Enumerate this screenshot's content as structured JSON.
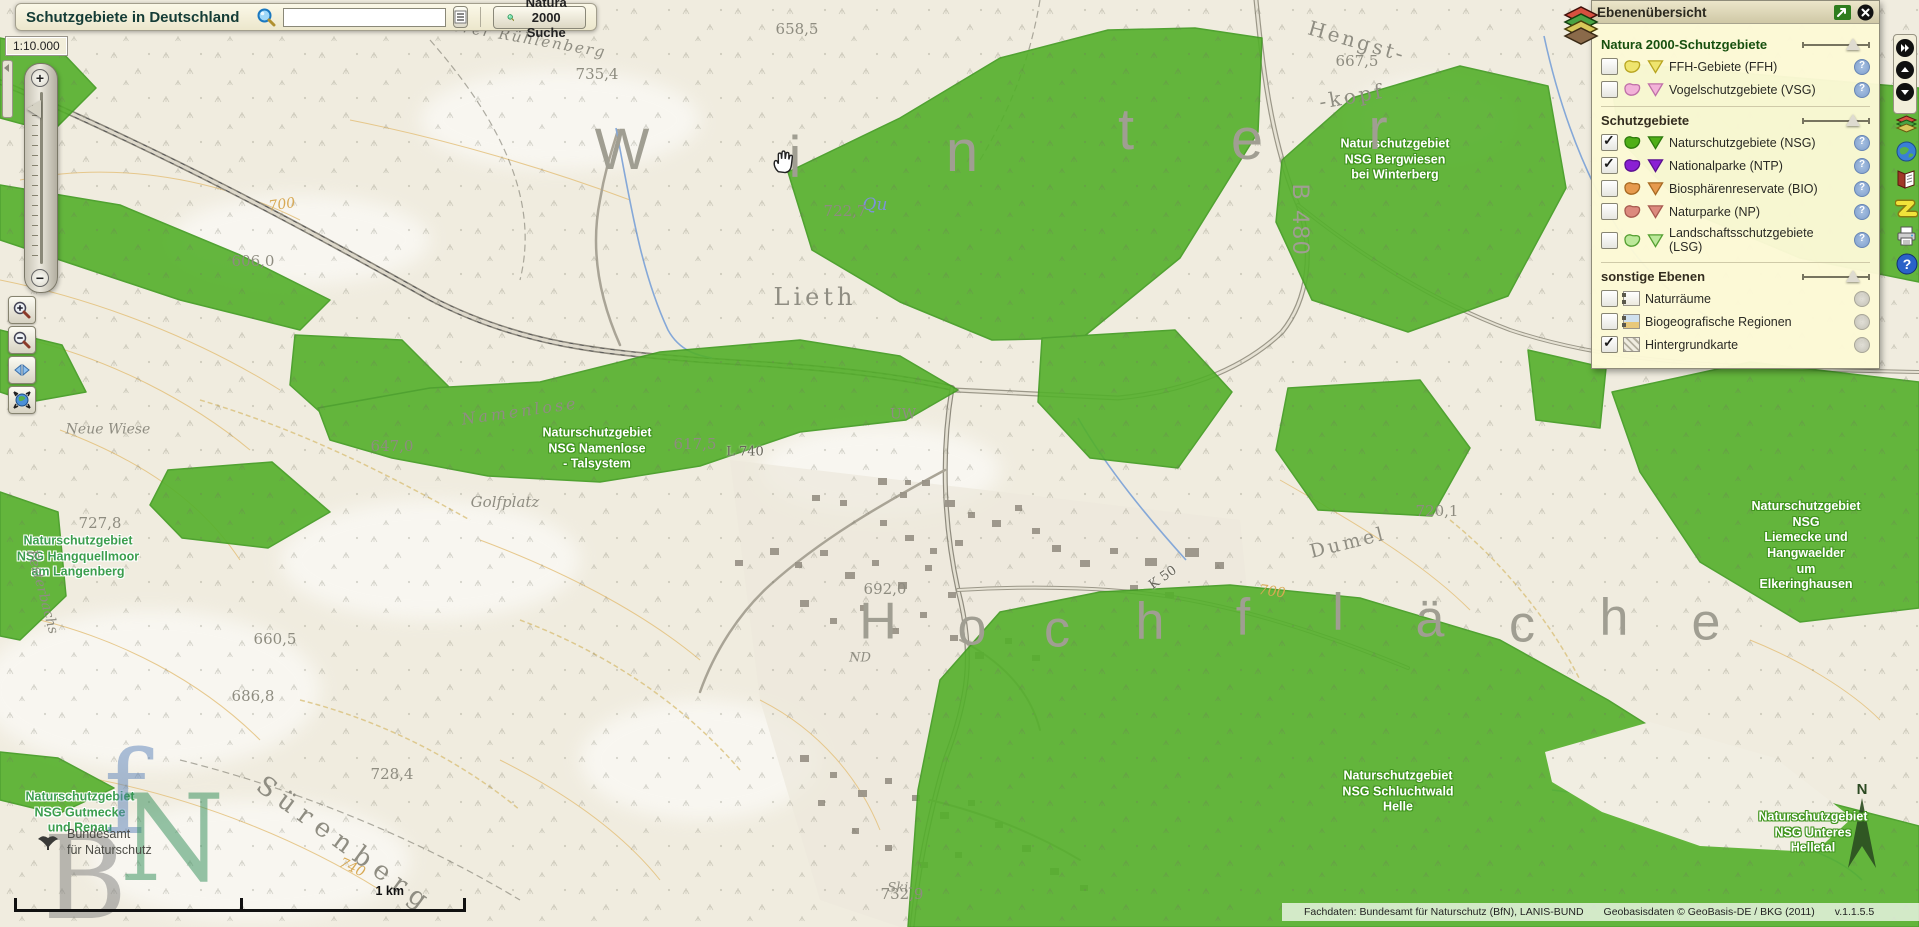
{
  "header": {
    "title": "Schutzgebiete in Deutschland",
    "search_value": "",
    "natura_button_label": "Natura 2000 Suche"
  },
  "scale_indicator": "1:10.000",
  "scalebar_label": "1 km",
  "layer_panel": {
    "title": "Ebenenübersicht",
    "sections": [
      {
        "title": "Natura 2000-Schutzgebiete",
        "title_color": "#17500f",
        "layers": [
          {
            "label": "FFH-Gebiete (FFH)",
            "checked": false,
            "fill": "#efe46e",
            "border": "#b8a520",
            "info": "q"
          },
          {
            "label": "Vogelschutzgebiete (VSG)",
            "checked": false,
            "fill": "#f2b2d8",
            "border": "#c070a8",
            "info": "q"
          }
        ]
      },
      {
        "title": "Schutzgebiete",
        "title_color": "#332d1f",
        "layers": [
          {
            "label": "Naturschutzgebiete (NSG)",
            "checked": true,
            "fill": "#4fae17",
            "border": "#2c7a0c",
            "info": "q"
          },
          {
            "label": "Nationalparke (NTP)",
            "checked": true,
            "fill": "#8a1fd4",
            "border": "#5a1090",
            "info": "q"
          },
          {
            "label": "Biosphärenreservate (BIO)",
            "checked": false,
            "fill": "#e69a4e",
            "border": "#a86a22",
            "info": "q"
          },
          {
            "label": "Naturparke (NP)",
            "checked": false,
            "fill": "#dc8a7e",
            "border": "#a85a50",
            "info": "q"
          },
          {
            "label": "Landschaftsschutzgebiete (LSG)",
            "checked": false,
            "fill": "#bce89a",
            "border": "#55a032",
            "info": "q"
          }
        ]
      },
      {
        "title": "sonstige Ebenen",
        "title_color": "#332d1f",
        "layers": [
          {
            "label": "Naturräume",
            "checked": false,
            "icon": "naturraeume",
            "info": "g"
          },
          {
            "label": "Biogeografische Regionen",
            "checked": false,
            "icon": "biogeo",
            "info": "g"
          },
          {
            "label": "Hintergrundkarte",
            "checked": true,
            "icon": "hatch",
            "info": "g"
          }
        ]
      }
    ]
  },
  "attribution": {
    "fachdaten": "Fachdaten: Bundesamt für Naturschutz (BfN), LANIS-BUND",
    "geobasis": "Geobasisdaten © GeoBasis-DE / BKG (2011)",
    "version": "v.1.1.5.5"
  },
  "logo": {
    "line1": "Bundesamt",
    "line2": "für Naturschutz"
  },
  "colors": {
    "nsg_green": "#54b02b",
    "nsg_border": "#3f9a1f",
    "panel_bg": "#fbf8d6",
    "map_base": "#f0ecdf"
  },
  "map": {
    "labels": [
      {
        "t": "Naturschutzgebiet\nNSG Bergwiesen\nbei Winterberg",
        "x": 1395,
        "y": 160,
        "c": "on-green"
      },
      {
        "t": "Naturschutzgebiet\nNSG Namenlose\n- Talsystem",
        "x": 597,
        "y": 449,
        "c": "on-green"
      },
      {
        "t": "Naturschutzgebiet NSG\nLiemecke und Hangwaelder\num Elkeringhausen",
        "x": 1806,
        "y": 546,
        "c": "on-green"
      },
      {
        "t": "Naturschutzgebiet\nNSG Schluchtwald\nHelle",
        "x": 1398,
        "y": 792,
        "c": "on-green"
      },
      {
        "t": "Naturschutzgebiet\nNSG Unteres\nHelletal",
        "x": 1813,
        "y": 833,
        "c": "on-green"
      },
      {
        "t": "Naturschutzgebiet\nNSG Hangquellmoor\nam Langenberg",
        "x": 78,
        "y": 557,
        "c": "on-cream"
      },
      {
        "t": "Naturschutzgebiet\nNSG Gutmecke\nund Renau",
        "x": 80,
        "y": 813,
        "c": "on-cream"
      },
      {
        "t": "W",
        "x": 622,
        "y": 150,
        "c": "spread",
        "s": 58
      },
      {
        "t": "i",
        "x": 795,
        "y": 158,
        "c": "spread",
        "s": 58
      },
      {
        "t": "n",
        "x": 962,
        "y": 152,
        "c": "spread",
        "s": 58
      },
      {
        "t": "t",
        "x": 1126,
        "y": 130,
        "c": "spread",
        "s": 58
      },
      {
        "t": "e",
        "x": 1247,
        "y": 140,
        "c": "spread",
        "s": 58
      },
      {
        "t": "r",
        "x": 1378,
        "y": 130,
        "c": "spread",
        "s": 58
      },
      {
        "t": "H",
        "x": 878,
        "y": 622,
        "c": "spread",
        "s": 52
      },
      {
        "t": "o",
        "x": 972,
        "y": 628,
        "c": "spread",
        "s": 52
      },
      {
        "t": "c",
        "x": 1057,
        "y": 630,
        "c": "spread",
        "s": 52
      },
      {
        "t": "h",
        "x": 1150,
        "y": 622,
        "c": "spread",
        "s": 52
      },
      {
        "t": "f",
        "x": 1243,
        "y": 618,
        "c": "spread",
        "s": 52
      },
      {
        "t": "l",
        "x": 1338,
        "y": 613,
        "c": "spread",
        "s": 52
      },
      {
        "t": "ä",
        "x": 1430,
        "y": 620,
        "c": "spread",
        "s": 52
      },
      {
        "t": "c",
        "x": 1522,
        "y": 625,
        "c": "spread",
        "s": 52
      },
      {
        "t": "h",
        "x": 1614,
        "y": 618,
        "c": "spread",
        "s": 52
      },
      {
        "t": "e",
        "x": 1706,
        "y": 623,
        "c": "spread",
        "s": 52
      },
      {
        "t": "B 480",
        "x": 1300,
        "y": 220,
        "c": "spread",
        "s": 24,
        "ls": 2,
        "r": 90
      },
      {
        "t": "Lieth",
        "x": 815,
        "y": 297,
        "c": "place",
        "s": 24,
        "ls": 4
      },
      {
        "t": "Hengst-",
        "x": 1357,
        "y": 42,
        "c": "place",
        "s": 20,
        "ls": 3,
        "r": 16
      },
      {
        "t": "-kopf",
        "x": 1352,
        "y": 97,
        "c": "place",
        "s": 20,
        "ls": 3,
        "r": -10
      },
      {
        "t": "Sürenberg",
        "x": 345,
        "y": 845,
        "c": "place",
        "s": 26,
        "ls": 8,
        "r": 36
      },
      {
        "t": "Dumel",
        "x": 1348,
        "y": 543,
        "c": "place",
        "s": 19,
        "ls": 3,
        "r": -14
      },
      {
        "t": "Golfplatz",
        "x": 505,
        "y": 503,
        "c": "place-italic",
        "s": 15
      },
      {
        "t": "Neue Wiese",
        "x": 108,
        "y": 430,
        "c": "place-italic",
        "s": 14
      },
      {
        "t": "Festerbachs",
        "x": 42,
        "y": 592,
        "c": "place-italic",
        "s": 14,
        "r": 75
      },
      {
        "t": "Namenlose",
        "x": 520,
        "y": 412,
        "c": "place-italic",
        "s": 16,
        "ls": 3,
        "r": -8
      },
      {
        "t": "Vorderer Rühlenberg",
        "x": 508,
        "y": 36,
        "c": "place-italic",
        "s": 15,
        "ls": 2,
        "r": 10
      },
      {
        "t": "UW",
        "x": 903,
        "y": 415,
        "c": "place",
        "s": 14
      },
      {
        "t": "ND",
        "x": 860,
        "y": 658,
        "c": "place-italic",
        "s": 13
      },
      {
        "t": "Qu",
        "x": 875,
        "y": 205,
        "c": "water",
        "s": 17
      },
      {
        "t": "Ski-",
        "x": 900,
        "y": 888,
        "c": "place-italic",
        "s": 13
      },
      {
        "t": "L 740",
        "x": 745,
        "y": 452,
        "c": "roadlbl",
        "s": 13
      },
      {
        "t": "K 50",
        "x": 1163,
        "y": 578,
        "c": "roadlbl",
        "s": 13,
        "r": -35
      },
      {
        "t": "667,5",
        "x": 1357,
        "y": 62,
        "c": "elev"
      },
      {
        "t": "735,4",
        "x": 597,
        "y": 75,
        "c": "elev"
      },
      {
        "t": "658,5",
        "x": 797,
        "y": 30,
        "c": "elev"
      },
      {
        "t": "722,7",
        "x": 845,
        "y": 212,
        "c": "elev"
      },
      {
        "t": "606,0",
        "x": 253,
        "y": 262,
        "c": "elev"
      },
      {
        "t": "647,0",
        "x": 392,
        "y": 447,
        "c": "elev"
      },
      {
        "t": "617,5",
        "x": 695,
        "y": 445,
        "c": "elev"
      },
      {
        "t": "692,0",
        "x": 885,
        "y": 590,
        "c": "elev"
      },
      {
        "t": "660,5",
        "x": 275,
        "y": 640,
        "c": "elev"
      },
      {
        "t": "686,8",
        "x": 253,
        "y": 697,
        "c": "elev"
      },
      {
        "t": "727,8",
        "x": 100,
        "y": 524,
        "c": "elev"
      },
      {
        "t": "720,1",
        "x": 1437,
        "y": 512,
        "c": "elev"
      },
      {
        "t": "728,4",
        "x": 392,
        "y": 775,
        "c": "elev"
      },
      {
        "t": "732,9",
        "x": 902,
        "y": 895,
        "c": "elev"
      },
      {
        "t": "700",
        "x": 282,
        "y": 205,
        "c": "contour",
        "s": 14,
        "r": -8
      },
      {
        "t": "700",
        "x": 1272,
        "y": 592,
        "c": "contour",
        "s": 14,
        "r": 8
      },
      {
        "t": "740",
        "x": 352,
        "y": 868,
        "c": "contour",
        "s": 14,
        "r": 25
      },
      {
        "t": "B",
        "x": 85,
        "y": 880,
        "c": "wm-gray",
        "s": 115
      },
      {
        "t": "f",
        "x": 125,
        "y": 795,
        "c": "wm-blue",
        "s": 115
      },
      {
        "t": "N",
        "x": 172,
        "y": 840,
        "c": "wm-green",
        "s": 120
      },
      {
        "t": "N",
        "x": 1862,
        "y": 790,
        "c": "compass",
        "s": 15
      }
    ]
  }
}
